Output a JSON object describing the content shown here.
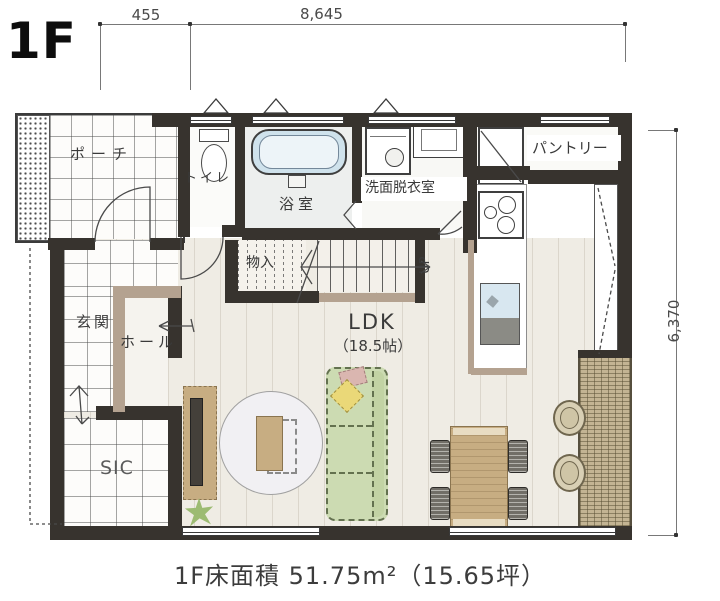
{
  "header": {
    "floor_label": "1F"
  },
  "dimensions": {
    "top_left_mm": "455",
    "top_mm": "8,645",
    "right_mm": "6,370"
  },
  "rooms": {
    "porch": "ポーチ",
    "toilet": "トイレ",
    "bath": "浴室",
    "washroom": "洗面脱衣室",
    "pantry": "パントリー",
    "entrance": "玄関",
    "hall": "ホール",
    "storage": "物入",
    "sic": "SIC",
    "ldk_name": "LDK",
    "ldk_size": "（18.5帖）",
    "stairs_up": "UP"
  },
  "caption": "1F床面積 51.75m²（15.65坪）",
  "colors": {
    "wall": "#37332e",
    "half_wall_tan": "#b4a290",
    "wood_floor": "#efece4",
    "bathtub_blue": "#cfe2ec",
    "sink_blue": "#d8e7f0",
    "sofa_green": "#ccdbb2",
    "cushion_yellow": "#ead878",
    "cushion_pink": "#dab6b0",
    "furniture_wood": "#c7ad82",
    "deck_tan": "#c3b493"
  }
}
